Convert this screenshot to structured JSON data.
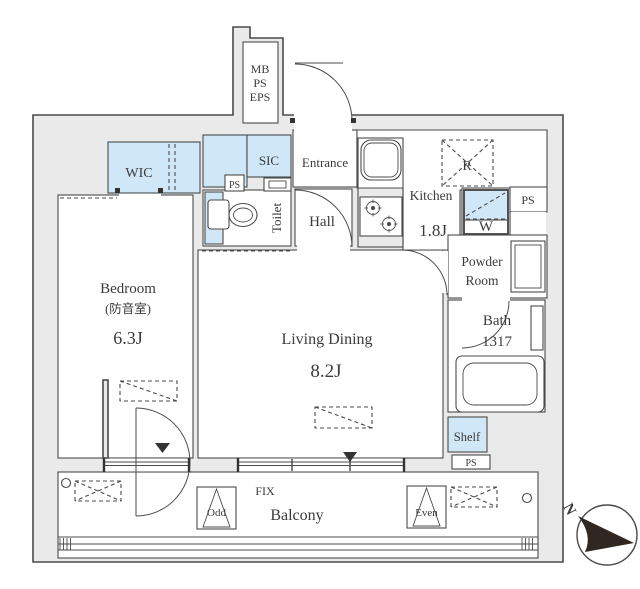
{
  "title": "Apartment floor plan",
  "colors": {
    "highlight": "#cfe7f7",
    "wall": "#eaeaea",
    "line": "#4b4b4b",
    "text": "#3b3b3b",
    "compass": "#2e2722"
  },
  "shaft": {
    "lines": [
      "MB",
      "PS",
      "EPS"
    ]
  },
  "rooms": {
    "wic": "WIC",
    "sic": "SIC",
    "entrance": "Entrance",
    "hall": "Hall",
    "toilet": "Toilet",
    "kitchen": {
      "name": "Kitchen",
      "size": "1.8J"
    },
    "refrigerator": "R",
    "washer": "W",
    "ps_small": "PS",
    "ps_upper_right": "PS",
    "ps_lower": "PS",
    "powder": {
      "line1": "Powder",
      "line2": "Room"
    },
    "bath": {
      "name": "Bath",
      "size": "1317"
    },
    "bedroom": {
      "name": "Bedroom",
      "sub": "(防音室)",
      "size": "6.3J"
    },
    "living": {
      "name": "Living Dining",
      "size": "8.2J"
    },
    "shelf": "Shelf"
  },
  "balcony": {
    "label": "Balcony",
    "fix": "FIX",
    "odd": "Odd",
    "even": "Even"
  },
  "compass": {
    "north": "N"
  }
}
